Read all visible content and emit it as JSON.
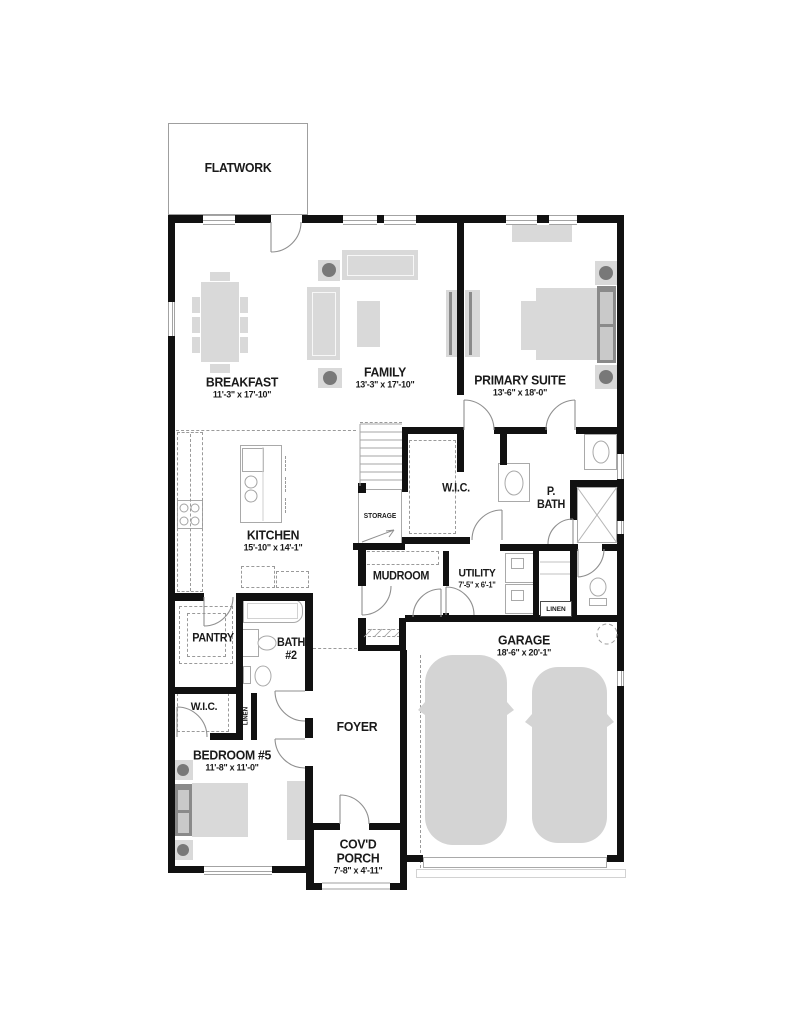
{
  "plan_title": "First floor plan",
  "rooms": {
    "flatwork": {
      "name": "FLATWORK"
    },
    "breakfast": {
      "name": "BREAKFAST",
      "dims": "11'-3\" x 17'-10\""
    },
    "family": {
      "name": "FAMILY",
      "dims": "13'-3\" x 17'-10\""
    },
    "primary_suite": {
      "name": "PRIMARY SUITE",
      "dims": "13'-6\" x 18'-0\""
    },
    "kitchen": {
      "name": "KITCHEN",
      "dims": "15'-10\" x 14'-1\""
    },
    "wic_primary": {
      "name": "W.I.C."
    },
    "primary_bath": {
      "line1": "P.",
      "line2": "BATH"
    },
    "storage": {
      "name": "STORAGE"
    },
    "mudroom": {
      "name": "MUDROOM"
    },
    "utility": {
      "name": "UTILITY",
      "dims": "7'-5\" x 6'-1\""
    },
    "pantry": {
      "name": "PANTRY"
    },
    "bath2": {
      "line1": "BATH",
      "line2": "#2"
    },
    "linen_hall": {
      "name": "LINEN"
    },
    "garage": {
      "name": "GARAGE",
      "dims": "18'-6\" x 20'-1\""
    },
    "wic_bedroom5": {
      "name": "W.I.C."
    },
    "linen_bedroom5": {
      "name": "LINEN"
    },
    "bedroom5": {
      "name": "BEDROOM #5",
      "dims": "11'-8\" x 11'-0\""
    },
    "foyer": {
      "name": "FOYER"
    },
    "covered_porch": {
      "line1": "COV'D",
      "line2": "PORCH",
      "dims": "7'-8\" x 4'-11\""
    }
  },
  "colors": {
    "wall": "#111111",
    "furniture": "#d9d9d9",
    "accent_dark": "#8a8a8a",
    "line": "#9f9f9f",
    "background": "#ffffff",
    "text": "#1a1a1a"
  }
}
